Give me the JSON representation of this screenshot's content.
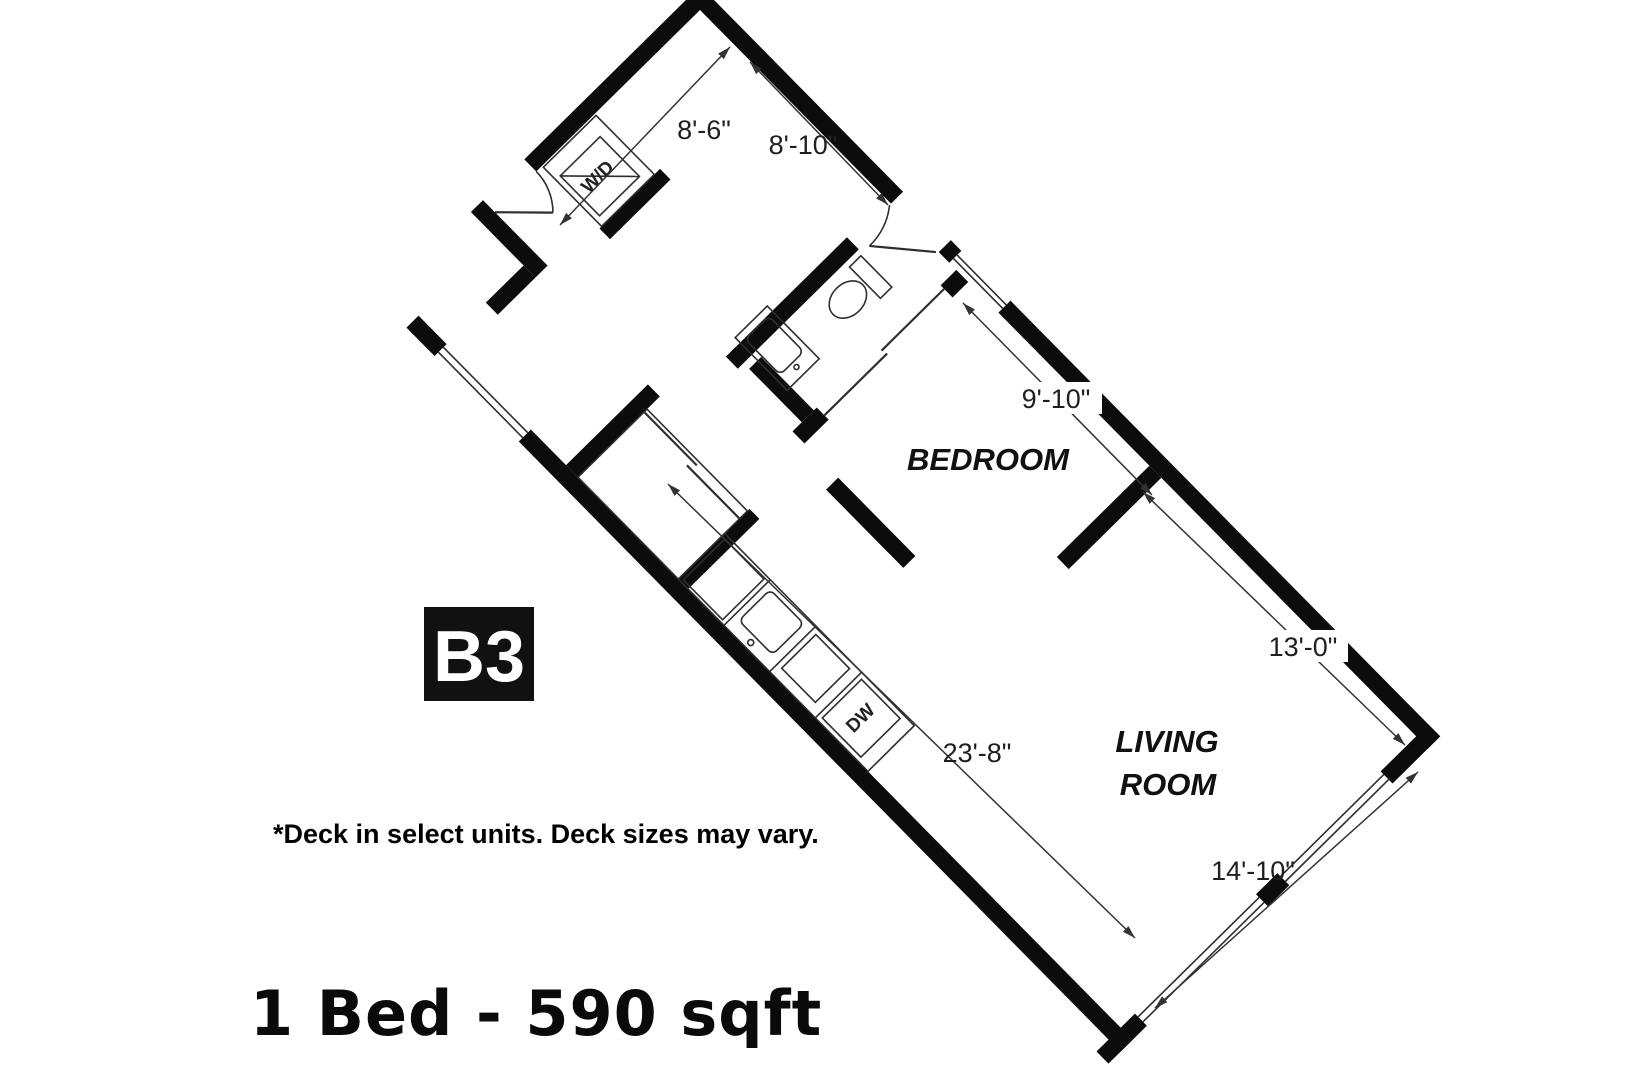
{
  "floor_plan": {
    "unit_label": "B3",
    "title": "1 Bed - 590 sqft",
    "footnote": "*Deck in select units. Deck sizes may vary.",
    "rooms": {
      "bedroom": "BEDROOM",
      "living_line1": "LIVING",
      "living_line2": "ROOM"
    },
    "appliances": {
      "washer_dryer": "W/D",
      "dishwasher": "DW"
    },
    "dimensions": {
      "entry_width": "8'-6\"",
      "entry_length": "8'-10\"",
      "bedroom_length": "9'-10\"",
      "living_length": "13'-0\"",
      "kitchen_hall_length": "23'-8\"",
      "living_width": "14'-10\""
    },
    "colors": {
      "walls": "#0c0c0c",
      "lines": "#333333",
      "badge_bg": "#111111",
      "badge_text": "#ffffff",
      "text": "#1a1a1a"
    }
  }
}
